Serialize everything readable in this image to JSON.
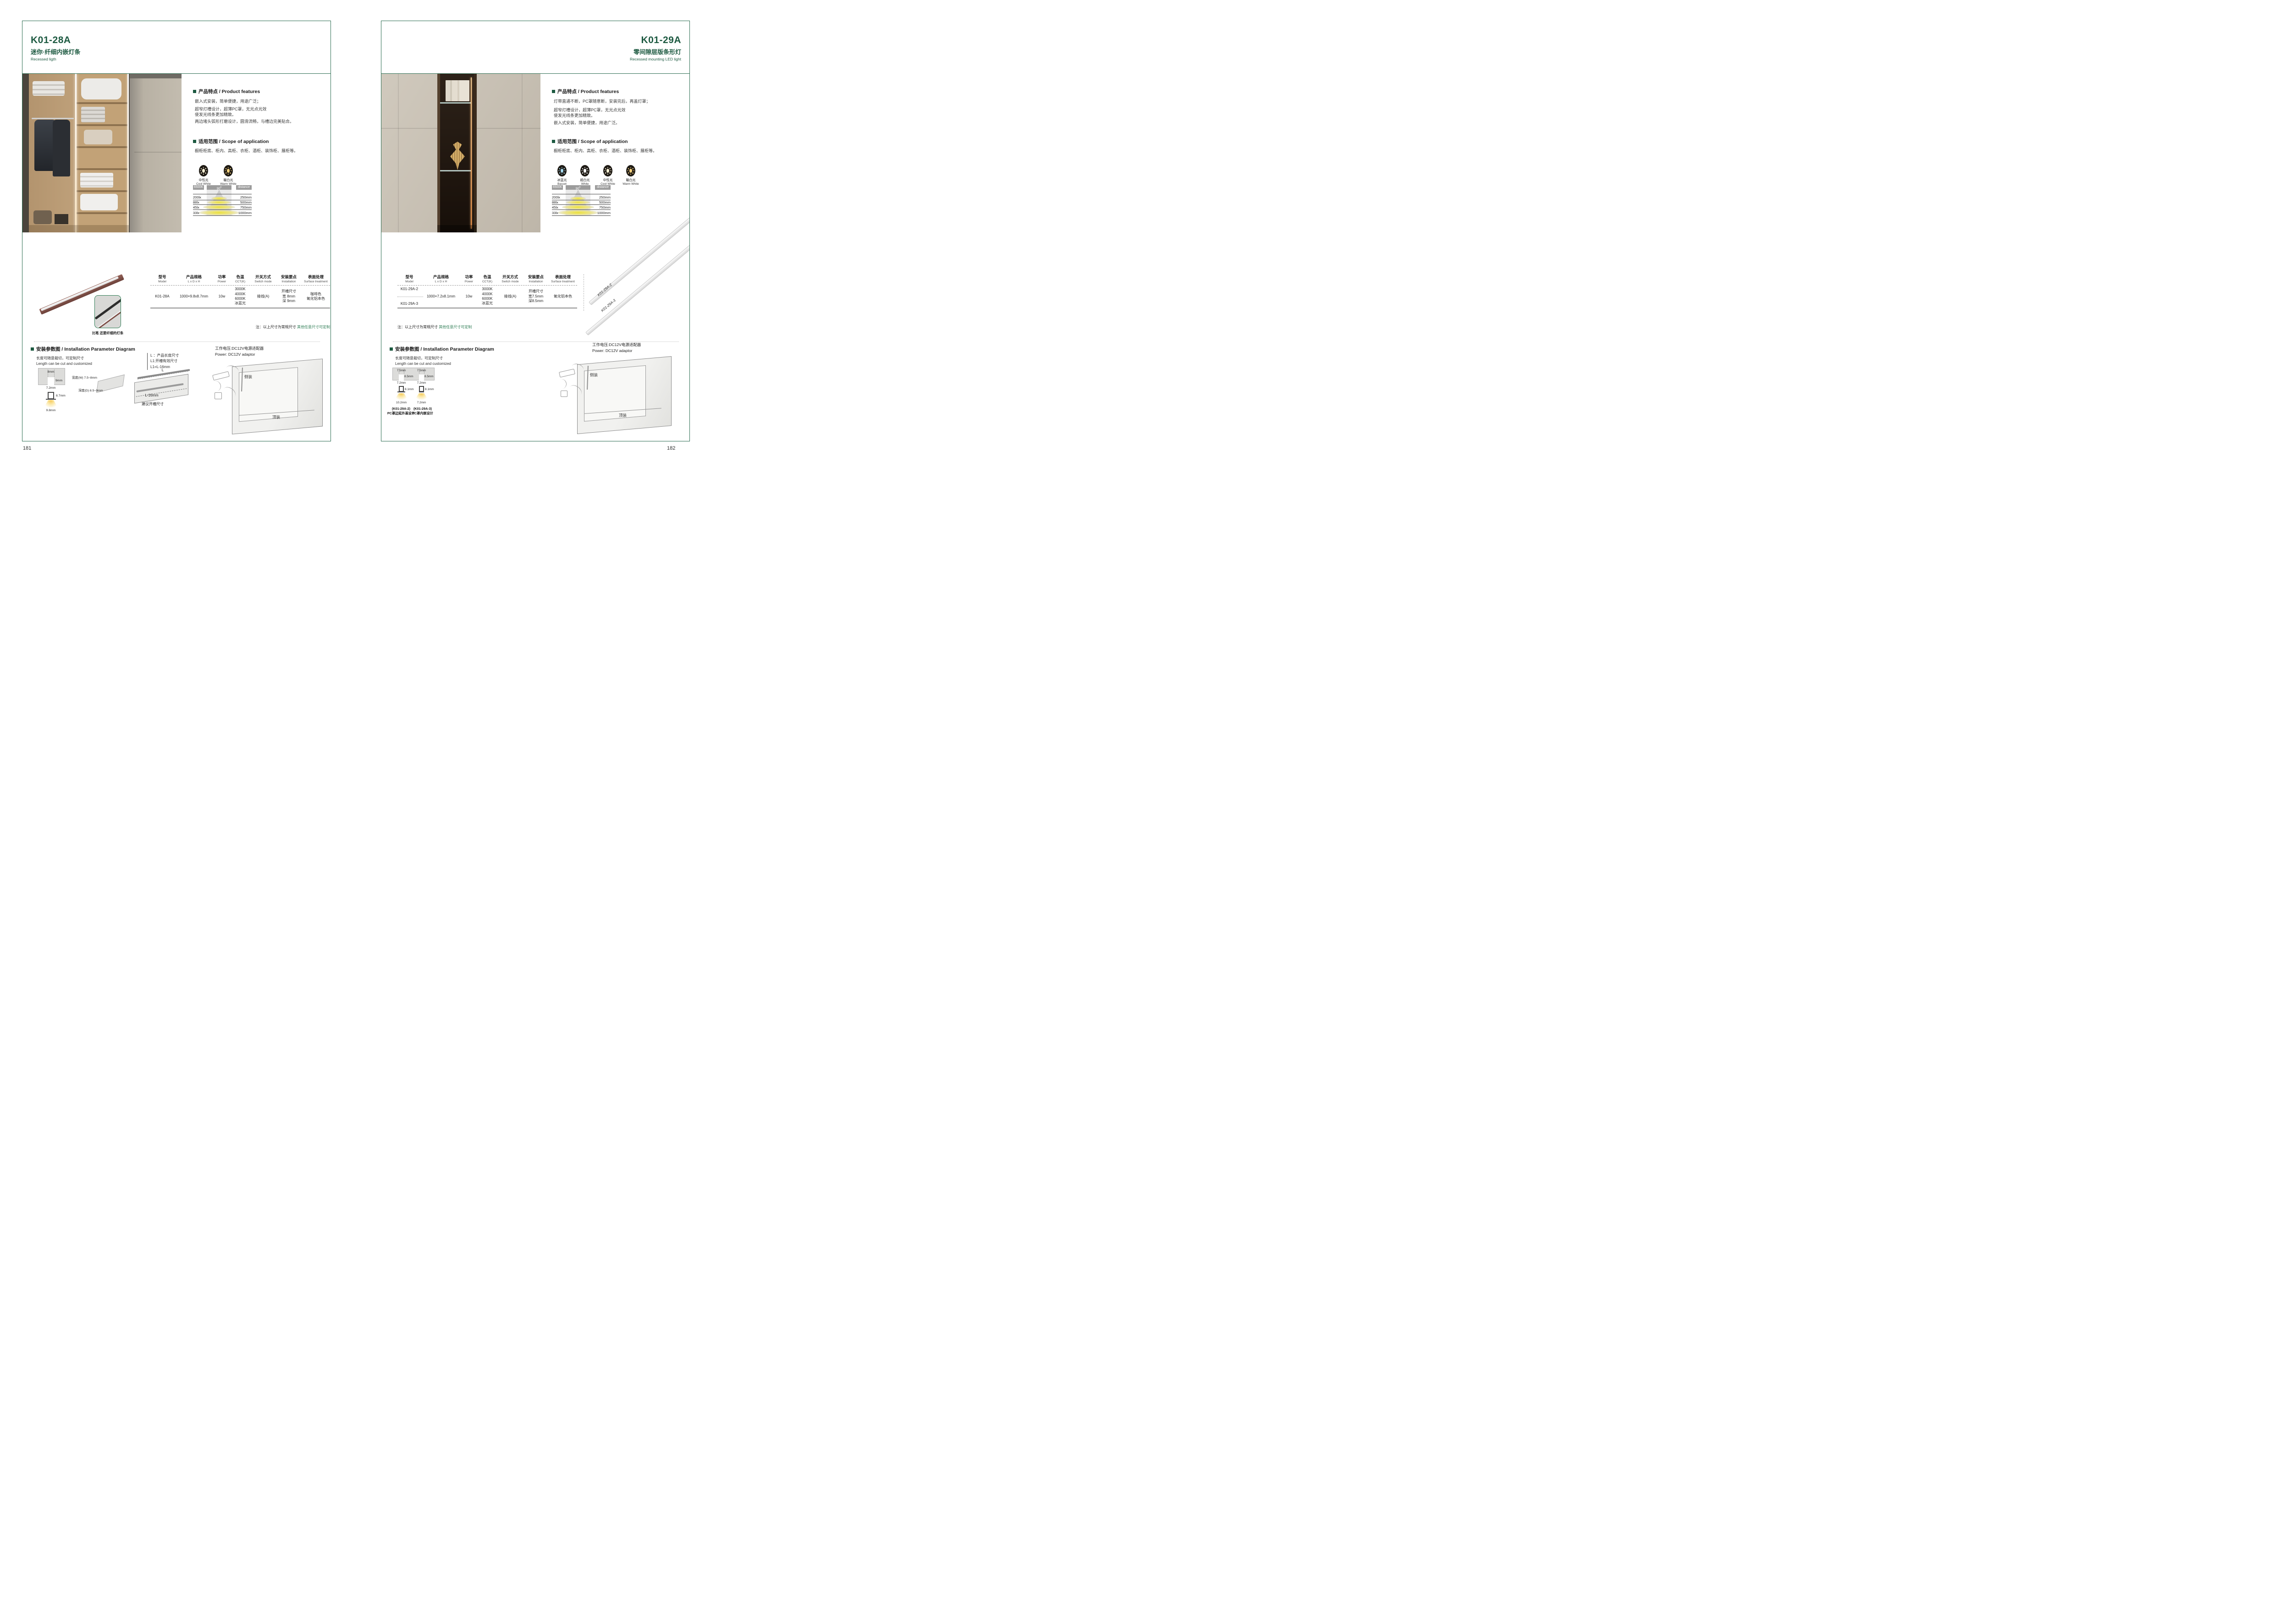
{
  "shared": {
    "photometric": {
      "cct": "6500K",
      "beam": "90",
      "beam_sup": "0",
      "distance": "distance",
      "rows": [
        {
          "lux": "200lx",
          "dist": "250mm"
        },
        {
          "lux": "88lx",
          "dist": "500mm"
        },
        {
          "lux": "45lx",
          "dist": "750mm"
        },
        {
          "lux": "33lx",
          "dist": "1000mm"
        }
      ]
    },
    "table_columns": [
      {
        "cn": "型号",
        "en": "Model"
      },
      {
        "cn": "产品规格",
        "en": "L x D x H"
      },
      {
        "cn": "功率",
        "en": "Power"
      },
      {
        "cn": "色温",
        "en": "CCT(K)"
      },
      {
        "cn": "开关方式",
        "en": "Switch mode"
      },
      {
        "cn": "安装要点",
        "en": "Installation"
      },
      {
        "cn": "表面处理",
        "en": "Surface treatment"
      }
    ],
    "note": {
      "prefix": "注：以上尺寸为常规尺寸 ",
      "highlight": "其他任意尺寸可定制"
    },
    "install_title": "安装参数图 / Installation Parameter Diagram",
    "cut_cn": "长度可随意裁切，可定制尺寸",
    "cut_en": "Length can be cut and customized",
    "power_cn": "工作电压:DC12V电源适配器",
    "power_en": "Power: DC12V adaptor",
    "cabinet": {
      "side": "侧装",
      "top": "顶装"
    }
  },
  "left": {
    "page_number": "181",
    "model": "K01-28A",
    "subtitle_cn": "迷你·纤细内嵌灯条",
    "subtitle_en": "Recessed ligth",
    "features_title": "产品特点 / Product features",
    "features": [
      "嵌入式安装，简单便捷，用途广泛；",
      "超窄灯槽设计，超薄PC罩，无光点光效",
      "使发光线条更加精致。",
      "两边堵头弧形打磨设计，圆滑流畅，与槽边完美贴合。"
    ],
    "scope_title": "适用范围 / Scope of application",
    "scope_text": "橱柜柜底、柜内、高柜、衣柜、酒柜、装饰柜、展柜等。",
    "icons": [
      {
        "cn": "中性光",
        "en": "Cool White",
        "color": "#fdf3d6"
      },
      {
        "cn": "暖白光",
        "en": "Warm White",
        "color": "#f5d17e"
      }
    ],
    "row": {
      "model": "K01-28A",
      "spec": "1000×9.8x8.7mm",
      "power": "10w",
      "cct": [
        "3000K",
        "4000K",
        "6000K",
        "冰蓝光"
      ],
      "switch": "接线(A)",
      "install": [
        "开槽尺寸",
        "宽 8mm",
        "深 9mm"
      ],
      "surface": [
        "咖啡色",
        "氧化铝本色"
      ]
    },
    "caption": "比笔 还要纤细的灯条",
    "cross": {
      "top": "8mm",
      "depth": "9mm",
      "width": "7.2mm",
      "height": "8.7mm",
      "bottom": "9.8mm"
    },
    "board": {
      "w": "宽度(W) 7.5~8mm",
      "d": "深度(D) 8.5~9mm"
    },
    "legend": [
      "L ：产品长度尺寸",
      "L1:开槽有效尺寸",
      "L1=L-16mm"
    ],
    "board2": {
      "L": "L",
      "L16": "L-16mm",
      "caption": "建议开槽尺寸"
    }
  },
  "right": {
    "page_number": "182",
    "model": "K01-29A",
    "subtitle_cn": "零间隙层版条形灯",
    "subtitle_en": "Recessed mounting LED light",
    "features_title": "产品特点 / Product features",
    "features": [
      "灯带直通不断，PC罩随意断，安装完后，再盖灯罩；",
      "超窄灯槽设计，超薄PC罩，无光点光效",
      "使发光线条更加精致。",
      "嵌入式安装，简单便捷，用途广泛。"
    ],
    "scope_title": "适用范围 / Scope of application",
    "scope_text": "橱柜柜底、柜内、高柜、衣柜、酒柜、装饰柜、展柜等。",
    "icons": [
      {
        "cn": "冰蓝光",
        "en": "Basset",
        "color": "#a8dcf2"
      },
      {
        "cn": "超白光",
        "en": "White",
        "color": "#ffffff"
      },
      {
        "cn": "中性光",
        "en": "Cool White",
        "color": "#fdf3d6"
      },
      {
        "cn": "暖白光",
        "en": "Warm White",
        "color": "#f5d17e"
      }
    ],
    "row": {
      "models": [
        "K01-29A-2",
        "K01-29A-3"
      ],
      "spec": "1000×7.2x8.1mm",
      "power": "10w",
      "cct": [
        "3000K",
        "4000K",
        "6000K",
        "冰蓝光"
      ],
      "switch": "接线(A)",
      "install": [
        "开槽尺寸",
        "宽7.5mm",
        "深8.5mm"
      ],
      "surface": [
        "氧化铝本色"
      ]
    },
    "strip_labels": [
      "K01-29A-2",
      "K01-29A-3"
    ],
    "cross1": {
      "top": "7.5mm",
      "depth": "8.5mm",
      "width": "7.2mm",
      "height": "8.1mm",
      "bottom": "10.2mm",
      "cap1": "(K01-29A-2)",
      "cap2": "PC罩边延外盖设计"
    },
    "cross2": {
      "top": "7.5mm",
      "depth": "8.5mm",
      "width": "7.2mm",
      "height": "8.1mm",
      "bottom": "7.2mm",
      "cap1": "(K01-29A-3)",
      "cap2": "PC罩内嵌设计"
    }
  }
}
